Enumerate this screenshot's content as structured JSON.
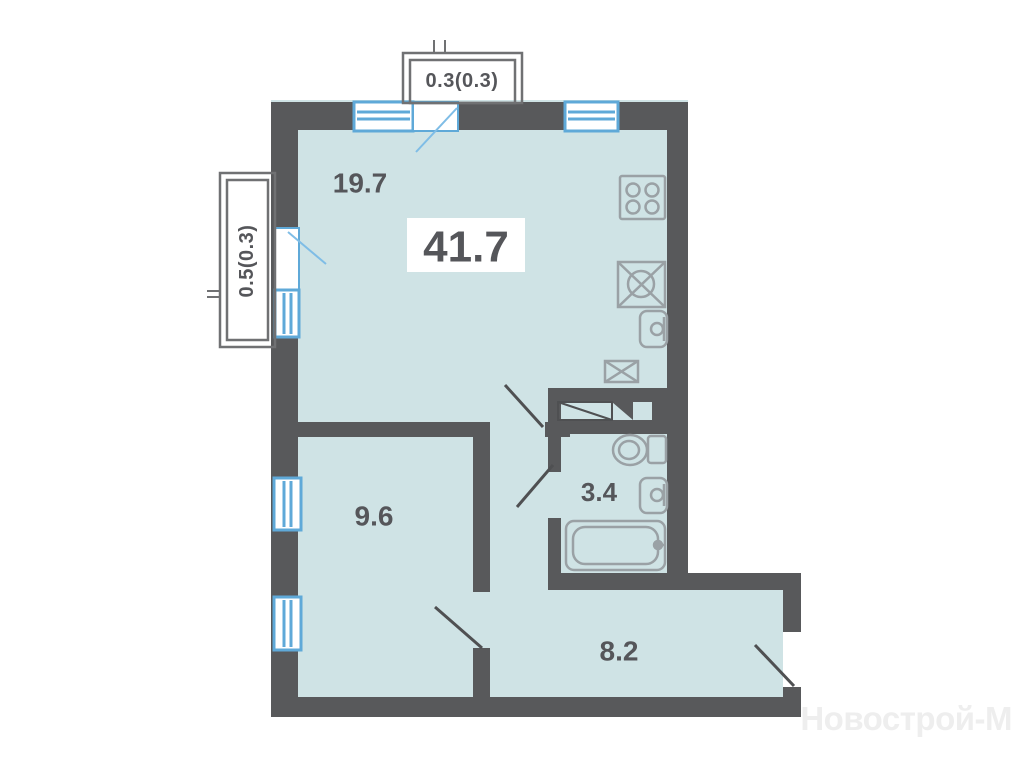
{
  "total_area": "41.7",
  "rooms": [
    {
      "id": "living-kitchen",
      "area": "19.7"
    },
    {
      "id": "bedroom",
      "area": "9.6"
    },
    {
      "id": "bathroom",
      "area": "3.4"
    },
    {
      "id": "hallway",
      "area": "8.2"
    }
  ],
  "balconies": [
    {
      "id": "balcony-top",
      "area": "0.3(0.3)"
    },
    {
      "id": "balcony-left",
      "area": "0.5(0.3)"
    }
  ],
  "watermark": "Новострой-М",
  "colors": {
    "wall": "#58595b",
    "floor": "#cfe3e5",
    "window": "#5fa9d8",
    "window_swing": "#7fbde6",
    "door_swing": "#4f5052",
    "icon": "#9aa1a5",
    "balcony_border": "#707173",
    "label": "#55565a",
    "area_box": "#ffffff",
    "watermark": "#eeeeee"
  }
}
